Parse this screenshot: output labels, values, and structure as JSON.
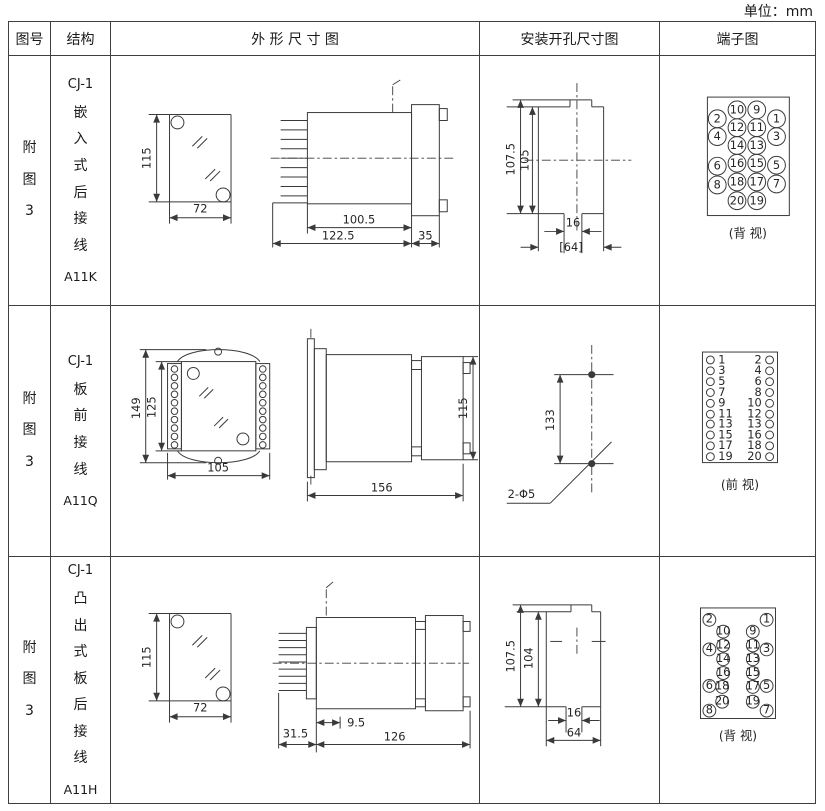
{
  "unit_label": "单位：mm",
  "header": {
    "figure_no": "图号",
    "structure": "结构",
    "outline": "外 形 尺 寸 图",
    "mounting": "安装开孔尺寸图",
    "terminal": "端子图"
  },
  "rows": [
    {
      "figure_no": "附图3",
      "model": "CJ-1",
      "structure": "嵌入式后接线",
      "code": "A11K",
      "outline_dims": {
        "front_h": "115",
        "front_w": "72",
        "body_len": "100.5",
        "total_len": "122.5",
        "flange_d": "35"
      },
      "mounting_dims": {
        "h_outer": "107.5",
        "h_inner": "105",
        "slot_w": "16",
        "total_w": "[64]"
      },
      "terminal_view": "(背 视)",
      "pins": [
        "10",
        "9",
        "2",
        "1",
        "12",
        "11",
        "4",
        "3",
        "14",
        "13",
        "16",
        "15",
        "6",
        "5",
        "18",
        "17",
        "8",
        "7",
        "20",
        "19"
      ]
    },
    {
      "figure_no": "附图3",
      "model": "CJ-1",
      "structure": "板前接线",
      "code": "A11Q",
      "outline_dims": {
        "front_h_outer": "149",
        "front_h_inner": "125",
        "front_w": "105",
        "side_len": "156",
        "side_h": "115"
      },
      "mounting_dims": {
        "hole_dist": "133",
        "hole_label": "2-Φ5"
      },
      "terminal_view": "(前 视)",
      "pins_left": [
        "1",
        "3",
        "5",
        "7",
        "9",
        "11",
        "13",
        "15",
        "17",
        "19"
      ],
      "pins_right": [
        "2",
        "4",
        "6",
        "8",
        "10",
        "12",
        "13",
        "16",
        "18",
        "20"
      ]
    },
    {
      "figure_no": "附图3",
      "model": "CJ-1",
      "structure": "凸出式板后接线",
      "code": "A11H",
      "outline_dims": {
        "front_h": "115",
        "front_w": "72",
        "pin_len": "31.5",
        "offset": "9.5",
        "body_len": "126"
      },
      "mounting_dims": {
        "h_outer": "107.5",
        "h_inner": "104",
        "slot_w": "16",
        "total_w": "64"
      },
      "terminal_view": "(背 视)",
      "pins": [
        "2",
        "1",
        "10",
        "9",
        "4",
        "12",
        "11",
        "3",
        "14",
        "13",
        "16",
        "15",
        "6",
        "18",
        "17",
        "5",
        "20",
        "19",
        "8",
        "7"
      ]
    }
  ]
}
